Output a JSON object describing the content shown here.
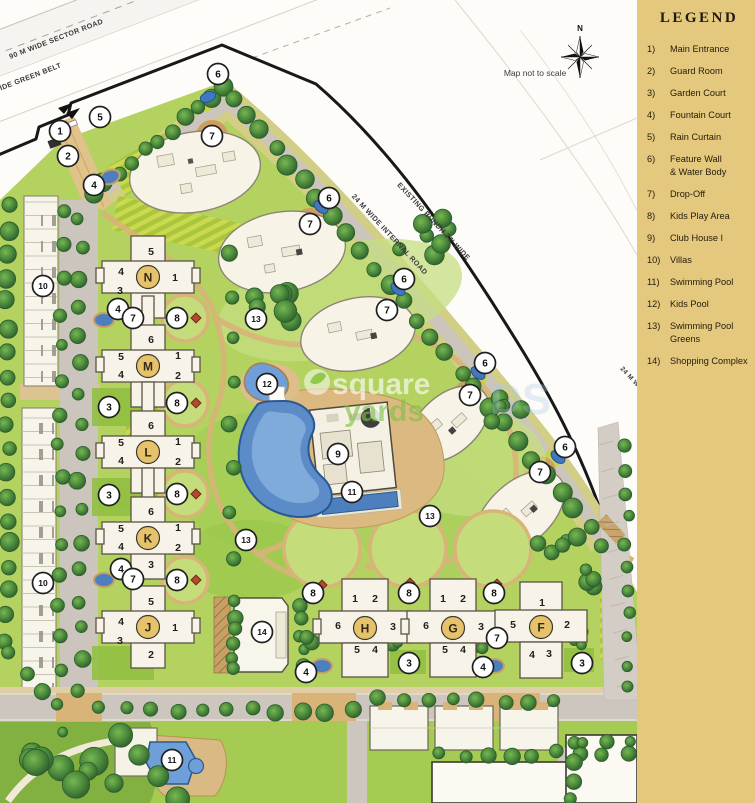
{
  "legend": {
    "title": "LEGEND",
    "items": [
      {
        "num": "1)",
        "lines": [
          "Main Entrance"
        ]
      },
      {
        "num": "2)",
        "lines": [
          "Guard Room"
        ]
      },
      {
        "num": "3)",
        "lines": [
          "Garden Court"
        ]
      },
      {
        "num": "4)",
        "lines": [
          "Fountain Court"
        ]
      },
      {
        "num": "5)",
        "lines": [
          "Rain Curtain"
        ]
      },
      {
        "num": "6)",
        "lines": [
          "Feature Wall",
          "& Water Body"
        ]
      },
      {
        "num": "7)",
        "lines": [
          "Drop-Off"
        ]
      },
      {
        "num": "8)",
        "lines": [
          "Kids Play Area"
        ]
      },
      {
        "num": "9)",
        "lines": [
          "Club House I"
        ]
      },
      {
        "num": "10)",
        "lines": [
          "Villas"
        ]
      },
      {
        "num": "11)",
        "lines": [
          "Swimming Pool"
        ]
      },
      {
        "num": "12)",
        "lines": [
          "Kids Pool"
        ]
      },
      {
        "num": "13)",
        "lines": [
          "Swimming Pool",
          "Greens"
        ]
      },
      {
        "num": "14)",
        "lines": [
          "Shopping Complex"
        ]
      }
    ]
  },
  "map": {
    "scale_note": "Map not to scale",
    "north_label": "N",
    "road_labels": [
      {
        "text": "90 M WIDE SECTOR ROAD",
        "x": 57,
        "y": 41,
        "rot": -21,
        "size": 7.2
      },
      {
        "text": "WIDE GREEN BELT",
        "x": 28,
        "y": 80,
        "rot": -21,
        "size": 7.2
      },
      {
        "text": "EXISTING BUNDH 77' WIDE",
        "x": 432,
        "y": 223,
        "rot": 47,
        "size": 7.2
      },
      {
        "text": "24 M WIDE INTERNAL ROAD",
        "x": 388,
        "y": 236,
        "rot": 47,
        "size": 7.2
      },
      {
        "text": "24 M WIDE ROAD",
        "x": 620,
        "y": 369,
        "rot": 47,
        "size": 6.5,
        "anchor": "start"
      }
    ],
    "towers": [
      {
        "letter": "N",
        "x": 148,
        "y": 277,
        "type": "col5"
      },
      {
        "letter": "M",
        "x": 148,
        "y": 366,
        "type": "col6"
      },
      {
        "letter": "L",
        "x": 148,
        "y": 452,
        "type": "col6"
      },
      {
        "letter": "K",
        "x": 148,
        "y": 538,
        "type": "col6"
      },
      {
        "letter": "J",
        "x": 148,
        "y": 627,
        "type": "col5"
      },
      {
        "letter": "H",
        "x": 365,
        "y": 628,
        "type": "row6"
      },
      {
        "letter": "G",
        "x": 453,
        "y": 628,
        "type": "row6"
      },
      {
        "letter": "F",
        "x": 541,
        "y": 627,
        "type": "rowF"
      }
    ],
    "wing_layouts": {
      "col5": [
        [
          5,
          3,
          -26
        ],
        [
          4,
          -27,
          -6
        ],
        [
          1,
          27,
          0
        ],
        [
          3,
          -28,
          13
        ],
        [
          2,
          3,
          27
        ]
      ],
      "col6": [
        [
          6,
          3,
          -27
        ],
        [
          5,
          -27,
          -10
        ],
        [
          1,
          30,
          -11
        ],
        [
          4,
          -27,
          8
        ],
        [
          2,
          30,
          9
        ],
        [
          3,
          3,
          26
        ]
      ],
      "row6": [
        [
          1,
          -10,
          -30
        ],
        [
          2,
          10,
          -30
        ],
        [
          6,
          -27,
          -3
        ],
        [
          3,
          28,
          -2
        ],
        [
          5,
          -8,
          21
        ],
        [
          4,
          10,
          21
        ]
      ],
      "rowF": [
        [
          1,
          1,
          -25
        ],
        [
          5,
          -28,
          -3
        ],
        [
          2,
          26,
          -3
        ],
        [
          4,
          -9,
          27
        ],
        [
          3,
          8,
          26
        ]
      ]
    },
    "markers": [
      {
        "n": 6,
        "x": 218,
        "y": 74
      },
      {
        "n": 5,
        "x": 100,
        "y": 117
      },
      {
        "n": 1,
        "x": 60,
        "y": 131
      },
      {
        "n": 2,
        "x": 68,
        "y": 156
      },
      {
        "n": 4,
        "x": 94,
        "y": 185
      },
      {
        "n": 7,
        "x": 212,
        "y": 136
      },
      {
        "n": 6,
        "x": 329,
        "y": 198
      },
      {
        "n": 7,
        "x": 310,
        "y": 224
      },
      {
        "n": 6,
        "x": 404,
        "y": 279
      },
      {
        "n": 7,
        "x": 387,
        "y": 310
      },
      {
        "n": 6,
        "x": 485,
        "y": 363
      },
      {
        "n": 7,
        "x": 470,
        "y": 395
      },
      {
        "n": 6,
        "x": 565,
        "y": 447
      },
      {
        "n": 7,
        "x": 540,
        "y": 472
      },
      {
        "n": 10,
        "x": 43,
        "y": 286
      },
      {
        "n": 10,
        "x": 43,
        "y": 583
      },
      {
        "n": 4,
        "x": 118,
        "y": 309
      },
      {
        "n": 7,
        "x": 133,
        "y": 318
      },
      {
        "n": 8,
        "x": 177,
        "y": 318
      },
      {
        "n": 3,
        "x": 109,
        "y": 407
      },
      {
        "n": 8,
        "x": 177,
        "y": 403
      },
      {
        "n": 13,
        "x": 256,
        "y": 319
      },
      {
        "n": 12,
        "x": 267,
        "y": 384
      },
      {
        "n": 9,
        "x": 338,
        "y": 454
      },
      {
        "n": 11,
        "x": 352,
        "y": 492
      },
      {
        "n": 13,
        "x": 430,
        "y": 516
      },
      {
        "n": 13,
        "x": 246,
        "y": 540
      },
      {
        "n": 3,
        "x": 109,
        "y": 495
      },
      {
        "n": 8,
        "x": 177,
        "y": 494
      },
      {
        "n": 4,
        "x": 121,
        "y": 569
      },
      {
        "n": 7,
        "x": 133,
        "y": 579
      },
      {
        "n": 8,
        "x": 177,
        "y": 580
      },
      {
        "n": 14,
        "x": 262,
        "y": 632
      },
      {
        "n": 11,
        "x": 172,
        "y": 760
      },
      {
        "n": 8,
        "x": 313,
        "y": 593
      },
      {
        "n": 8,
        "x": 409,
        "y": 593
      },
      {
        "n": 8,
        "x": 494,
        "y": 593
      },
      {
        "n": 7,
        "x": 497,
        "y": 638
      },
      {
        "n": 3,
        "x": 409,
        "y": 663
      },
      {
        "n": 4,
        "x": 306,
        "y": 672
      },
      {
        "n": 4,
        "x": 483,
        "y": 667
      },
      {
        "n": 3,
        "x": 582,
        "y": 663
      }
    ],
    "features": {
      "fountains": [
        [
          110,
          177,
          -20
        ],
        [
          104,
          320,
          0
        ],
        [
          104,
          580,
          0
        ],
        [
          322,
          666,
          0
        ],
        [
          494,
          666,
          0
        ]
      ],
      "ponds": [
        [
          208,
          97,
          -20
        ],
        [
          321,
          207,
          40
        ],
        [
          398,
          289,
          40
        ],
        [
          478,
          373,
          40
        ],
        [
          558,
          457,
          40
        ]
      ],
      "play_icons": [
        [
          196,
          318
        ],
        [
          196,
          403
        ],
        [
          196,
          494
        ],
        [
          196,
          580
        ],
        [
          322,
          585
        ],
        [
          410,
          583
        ],
        [
          497,
          584
        ]
      ]
    },
    "watermark": {
      "word1": "square",
      "word2": "yards",
      "word3": "DS"
    }
  },
  "colors": {
    "legend_bg": "#e3c87d",
    "lawn": "#b3d260",
    "tree": "#3c7438",
    "path_tan": "#d8b478",
    "road_gray": "#cbc5bd",
    "pool_blue": "#5b8cc8",
    "building": "#f7f3e8",
    "marker_stroke": "#1f1f1f",
    "tower_badge": "#e6c36b"
  }
}
